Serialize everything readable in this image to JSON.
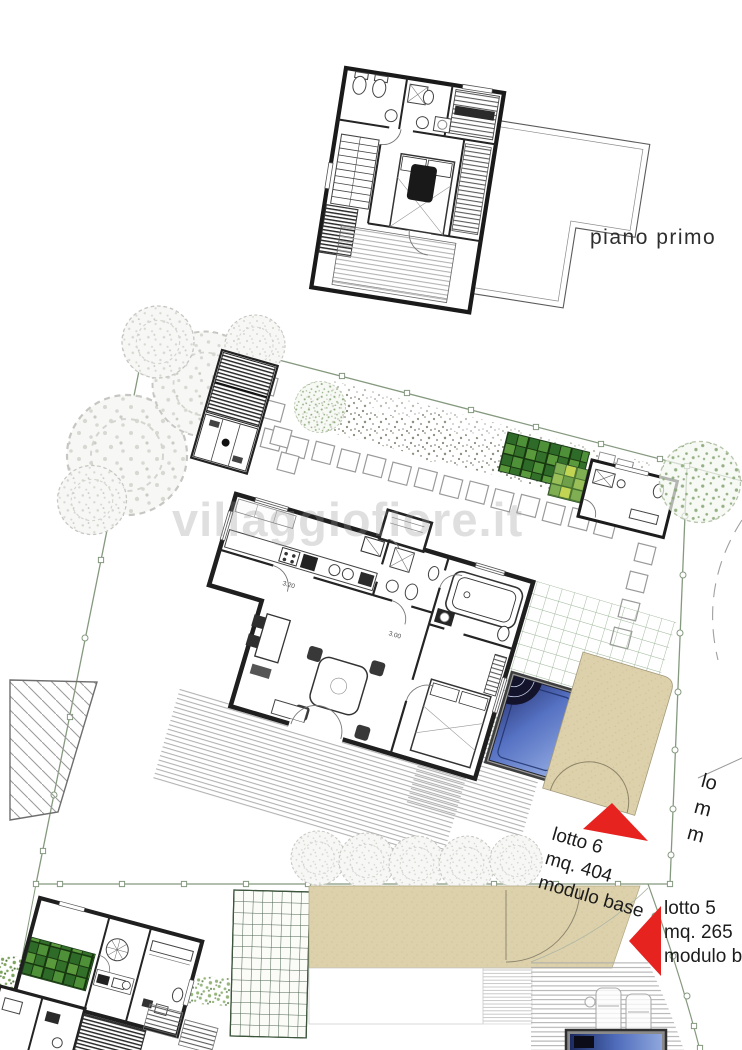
{
  "plan": {
    "floor_label": "piano primo",
    "watermark": "villaggiofiore.it",
    "lots": {
      "lotto6": {
        "name": "lotto 6",
        "area": "mq. 404",
        "module": "modulo base"
      },
      "lotto5": {
        "name": "lotto 5",
        "area": "mq. 265",
        "module": "modulo b"
      },
      "clipped": {
        "l1": "lo",
        "l2": "m",
        "l3": "m"
      }
    },
    "dims": {
      "d1": "3.00",
      "d2": "3.20"
    },
    "colors": {
      "arrow_red": "#e6231f",
      "pool_deep": "#27316f",
      "pool_light": "#94abe2",
      "patio_tan": "#ddd1ab",
      "boundary_green": "#85997f",
      "grid_green": "#2e6b28",
      "paper": "#ffffff",
      "ink": "#1f1f1f"
    }
  }
}
